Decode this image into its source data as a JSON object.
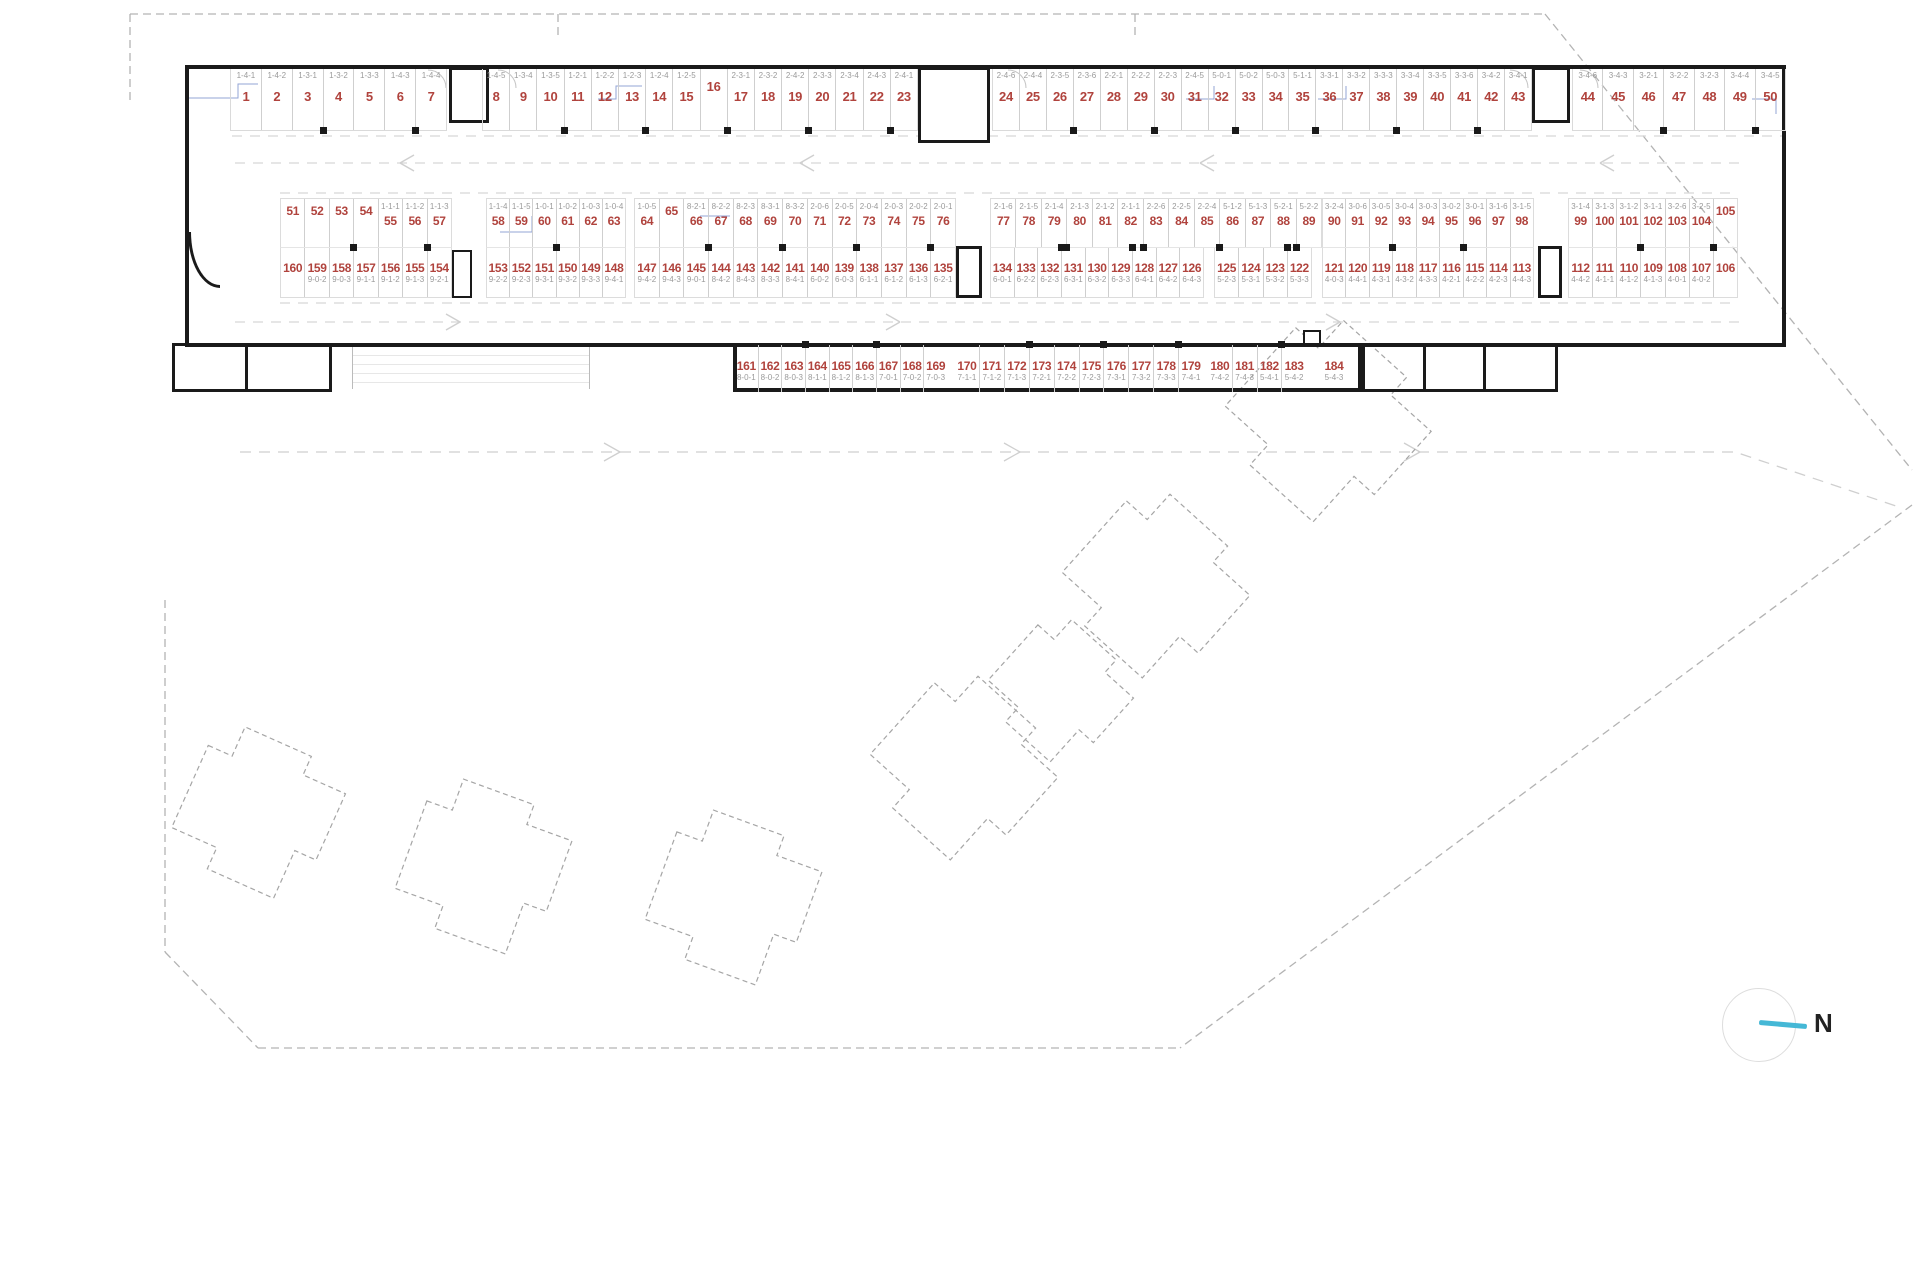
{
  "title": "underground parking level plan",
  "colors": {
    "space_number": "#b0433d",
    "space_code": "#9a9a9a",
    "wall": "#1a1a1a",
    "bay_line": "#cfcfcf",
    "site_dash": "#b3b3b3",
    "building_dash": "#a5a5a5",
    "blue_line": "#93a4d6",
    "north_needle": "#45b8d6"
  },
  "north": {
    "label": "N"
  },
  "parking": {
    "rows": [
      {
        "name": "top-row",
        "code_position": "above",
        "groups": [
          {
            "spaces": [
              {
                "n": "1",
                "c": "1-4-1"
              },
              {
                "n": "2",
                "c": "1-4-2"
              },
              {
                "n": "3",
                "c": "1-3-1"
              },
              {
                "n": "4",
                "c": "1-3-2"
              },
              {
                "n": "5",
                "c": "1-3-3"
              },
              {
                "n": "6",
                "c": "1-4-3"
              },
              {
                "n": "7",
                "c": "1-4-4"
              }
            ]
          },
          {
            "spaces": [
              {
                "n": "8",
                "c": "1-4-5"
              },
              {
                "n": "9",
                "c": "1-3-4"
              },
              {
                "n": "10",
                "c": "1-3-5"
              },
              {
                "n": "11",
                "c": "1-2-1"
              },
              {
                "n": "12",
                "c": "1-2-2"
              },
              {
                "n": "13",
                "c": "1-2-3"
              },
              {
                "n": "14",
                "c": "1-2-4"
              },
              {
                "n": "15",
                "c": "1-2-5"
              },
              {
                "n": "16",
                "c": ""
              },
              {
                "n": "17",
                "c": "2-3-1"
              },
              {
                "n": "18",
                "c": "2-3-2"
              },
              {
                "n": "19",
                "c": "2-4-2"
              },
              {
                "n": "20",
                "c": "2-3-3"
              },
              {
                "n": "21",
                "c": "2-3-4"
              },
              {
                "n": "22",
                "c": "2-4-3"
              },
              {
                "n": "23",
                "c": "2-4-1"
              }
            ]
          },
          {
            "spaces": [
              {
                "n": "24",
                "c": "2-4-6"
              },
              {
                "n": "25",
                "c": "2-4-4"
              },
              {
                "n": "26",
                "c": "2-3-5"
              },
              {
                "n": "27",
                "c": "2-3-6"
              },
              {
                "n": "28",
                "c": "2-2-1"
              },
              {
                "n": "29",
                "c": "2-2-2"
              },
              {
                "n": "30",
                "c": "2-2-3"
              },
              {
                "n": "31",
                "c": "2-4-5"
              },
              {
                "n": "32",
                "c": "5-0-1"
              },
              {
                "n": "33",
                "c": "5-0-2"
              },
              {
                "n": "34",
                "c": "5-0-3"
              },
              {
                "n": "35",
                "c": "5-1-1"
              },
              {
                "n": "36",
                "c": "3-3-1"
              },
              {
                "n": "37",
                "c": "3-3-2"
              },
              {
                "n": "38",
                "c": "3-3-3"
              },
              {
                "n": "39",
                "c": "3-3-4"
              },
              {
                "n": "40",
                "c": "3-3-5"
              },
              {
                "n": "41",
                "c": "3-3-6"
              },
              {
                "n": "42",
                "c": "3-4-2"
              },
              {
                "n": "43",
                "c": "3-4-1"
              }
            ]
          },
          {
            "spaces": [
              {
                "n": "44",
                "c": "3-4-6"
              },
              {
                "n": "45",
                "c": "3-4-3"
              },
              {
                "n": "46",
                "c": "3-2-1"
              },
              {
                "n": "47",
                "c": "3-2-2"
              },
              {
                "n": "48",
                "c": "3-2-3"
              },
              {
                "n": "49",
                "c": "3-4-4"
              },
              {
                "n": "50",
                "c": "3-4-5"
              }
            ]
          }
        ]
      },
      {
        "name": "middle-upper-row",
        "code_position": "above",
        "groups": [
          {
            "spaces": [
              {
                "n": "51",
                "c": ""
              },
              {
                "n": "52",
                "c": ""
              },
              {
                "n": "53",
                "c": ""
              },
              {
                "n": "54",
                "c": ""
              },
              {
                "n": "55",
                "c": "1-1-1"
              },
              {
                "n": "56",
                "c": "1-1-2"
              },
              {
                "n": "57",
                "c": "1-1-3"
              }
            ]
          },
          {
            "spaces": [
              {
                "n": "58",
                "c": "1-1-4"
              },
              {
                "n": "59",
                "c": "1-1-5"
              },
              {
                "n": "60",
                "c": "1-0-1"
              },
              {
                "n": "61",
                "c": "1-0-2"
              },
              {
                "n": "62",
                "c": "1-0-3"
              },
              {
                "n": "63",
                "c": "1-0-4"
              }
            ]
          },
          {
            "spaces": [
              {
                "n": "64",
                "c": "1-0-5"
              },
              {
                "n": "65",
                "c": ""
              },
              {
                "n": "66",
                "c": "8-2-1"
              },
              {
                "n": "67",
                "c": "8-2-2"
              },
              {
                "n": "68",
                "c": "8-2-3"
              },
              {
                "n": "69",
                "c": "8-3-1"
              },
              {
                "n": "70",
                "c": "8-3-2"
              },
              {
                "n": "71",
                "c": "2-0-6"
              },
              {
                "n": "72",
                "c": "2-0-5"
              },
              {
                "n": "73",
                "c": "2-0-4"
              },
              {
                "n": "74",
                "c": "2-0-3"
              },
              {
                "n": "75",
                "c": "2-0-2"
              },
              {
                "n": "76",
                "c": "2-0-1"
              }
            ]
          },
          {
            "spaces": [
              {
                "n": "77",
                "c": "2-1-6"
              },
              {
                "n": "78",
                "c": "2-1-5"
              },
              {
                "n": "79",
                "c": "2-1-4"
              },
              {
                "n": "80",
                "c": "2-1-3"
              },
              {
                "n": "81",
                "c": "2-1-2"
              },
              {
                "n": "82",
                "c": "2-1-1"
              },
              {
                "n": "83",
                "c": "2-2-6"
              },
              {
                "n": "84",
                "c": "2-2-5"
              },
              {
                "n": "85",
                "c": "2-2-4"
              },
              {
                "n": "86",
                "c": "5-1-2"
              },
              {
                "n": "87",
                "c": "5-1-3"
              },
              {
                "n": "88",
                "c": "5-2-1"
              },
              {
                "n": "89",
                "c": "5-2-2"
              }
            ]
          },
          {
            "spaces": [
              {
                "n": "90",
                "c": "3-2-4"
              },
              {
                "n": "91",
                "c": "3-0-6"
              },
              {
                "n": "92",
                "c": "3-0-5"
              },
              {
                "n": "93",
                "c": "3-0-4"
              },
              {
                "n": "94",
                "c": "3-0-3"
              },
              {
                "n": "95",
                "c": "3-0-2"
              },
              {
                "n": "96",
                "c": "3-0-1"
              },
              {
                "n": "97",
                "c": "3-1-6"
              },
              {
                "n": "98",
                "c": "3-1-5"
              }
            ]
          },
          {
            "spaces": [
              {
                "n": "99",
                "c": "3-1-4"
              },
              {
                "n": "100",
                "c": "3-1-3"
              },
              {
                "n": "101",
                "c": "3-1-2"
              },
              {
                "n": "102",
                "c": "3-1-1"
              },
              {
                "n": "103",
                "c": "3-2-6"
              },
              {
                "n": "104",
                "c": "3-2-5"
              },
              {
                "n": "105",
                "c": ""
              }
            ]
          }
        ]
      },
      {
        "name": "middle-lower-row",
        "code_position": "below",
        "groups": [
          {
            "spaces": [
              {
                "n": "160",
                "c": ""
              },
              {
                "n": "159",
                "c": "9-0-2"
              },
              {
                "n": "158",
                "c": "9-0-3"
              },
              {
                "n": "157",
                "c": "9-1-1"
              },
              {
                "n": "156",
                "c": "9-1-2"
              },
              {
                "n": "155",
                "c": "9-1-3"
              },
              {
                "n": "154",
                "c": "9-2-1"
              }
            ]
          },
          {
            "spaces": [
              {
                "n": "153",
                "c": "9-2-2"
              },
              {
                "n": "152",
                "c": "9-2-3"
              },
              {
                "n": "151",
                "c": "9-3-1"
              },
              {
                "n": "150",
                "c": "9-3-2"
              },
              {
                "n": "149",
                "c": "9-3-3"
              },
              {
                "n": "148",
                "c": "9-4-1"
              }
            ]
          },
          {
            "spaces": [
              {
                "n": "147",
                "c": "9-4-2"
              },
              {
                "n": "146",
                "c": "9-4-3"
              },
              {
                "n": "145",
                "c": "9-0-1"
              },
              {
                "n": "144",
                "c": "8-4-2"
              },
              {
                "n": "143",
                "c": "8-4-3"
              },
              {
                "n": "142",
                "c": "8-3-3"
              },
              {
                "n": "141",
                "c": "8-4-1"
              },
              {
                "n": "140",
                "c": "6-0-2"
              },
              {
                "n": "139",
                "c": "6-0-3"
              },
              {
                "n": "138",
                "c": "6-1-1"
              },
              {
                "n": "137",
                "c": "6-1-2"
              },
              {
                "n": "136",
                "c": "6-1-3"
              },
              {
                "n": "135",
                "c": "6-2-1"
              }
            ]
          },
          {
            "spaces": [
              {
                "n": "134",
                "c": "6-0-1"
              },
              {
                "n": "133",
                "c": "6-2-2"
              },
              {
                "n": "132",
                "c": "6-2-3"
              },
              {
                "n": "131",
                "c": "6-3-1"
              },
              {
                "n": "130",
                "c": "6-3-2"
              },
              {
                "n": "129",
                "c": "6-3-3"
              },
              {
                "n": "128",
                "c": "6-4-1"
              },
              {
                "n": "127",
                "c": "6-4-2"
              },
              {
                "n": "126",
                "c": "6-4-3"
              }
            ]
          },
          {
            "spaces": [
              {
                "n": "125",
                "c": "5-2-3"
              },
              {
                "n": "124",
                "c": "5-3-1"
              },
              {
                "n": "123",
                "c": "5-3-2"
              },
              {
                "n": "122",
                "c": "5-3-3"
              }
            ]
          },
          {
            "spaces": [
              {
                "n": "121",
                "c": "4-0-3"
              },
              {
                "n": "120",
                "c": "4-4-1"
              },
              {
                "n": "119",
                "c": "4-3-1"
              },
              {
                "n": "118",
                "c": "4-3-2"
              },
              {
                "n": "117",
                "c": "4-3-3"
              },
              {
                "n": "116",
                "c": "4-2-1"
              },
              {
                "n": "115",
                "c": "4-2-2"
              },
              {
                "n": "114",
                "c": "4-2-3"
              },
              {
                "n": "113",
                "c": "4-4-3"
              }
            ]
          },
          {
            "spaces": [
              {
                "n": "112",
                "c": "4-4-2"
              },
              {
                "n": "111",
                "c": "4-1-1"
              },
              {
                "n": "110",
                "c": "4-1-2"
              },
              {
                "n": "109",
                "c": "4-1-3"
              },
              {
                "n": "108",
                "c": "4-0-1"
              },
              {
                "n": "107",
                "c": "4-0-2"
              },
              {
                "n": "106",
                "c": ""
              }
            ]
          }
        ]
      },
      {
        "name": "bottom-row",
        "code_position": "below",
        "groups": [
          {
            "spaces": [
              {
                "n": "161",
                "c": "8-0-1"
              },
              {
                "n": "162",
                "c": "8-0-2"
              },
              {
                "n": "163",
                "c": "8-0-3"
              },
              {
                "n": "164",
                "c": "8-1-1"
              },
              {
                "n": "165",
                "c": "8-1-2"
              },
              {
                "n": "166",
                "c": "8-1-3"
              },
              {
                "n": "167",
                "c": "7-0-1"
              },
              {
                "n": "168",
                "c": "7-0-2"
              },
              {
                "n": "169",
                "c": "7-0-3"
              }
            ]
          },
          {
            "spaces": [
              {
                "n": "170",
                "c": "7-1-1"
              },
              {
                "n": "171",
                "c": "7-1-2"
              },
              {
                "n": "172",
                "c": "7-1-3"
              },
              {
                "n": "173",
                "c": "7-2-1"
              },
              {
                "n": "174",
                "c": "7-2-2"
              },
              {
                "n": "175",
                "c": "7-2-3"
              },
              {
                "n": "176",
                "c": "7-3-1"
              },
              {
                "n": "177",
                "c": "7-3-2"
              },
              {
                "n": "178",
                "c": "7-3-3"
              },
              {
                "n": "179",
                "c": "7-4-1"
              }
            ]
          },
          {
            "spaces": [
              {
                "n": "180",
                "c": "7-4-2"
              },
              {
                "n": "181",
                "c": "7-4-3"
              },
              {
                "n": "182",
                "c": "5-4-1"
              },
              {
                "n": "183",
                "c": "5-4-2"
              }
            ]
          },
          {
            "spaces": [
              {
                "n": "184",
                "c": "5-4-3"
              }
            ]
          }
        ]
      }
    ]
  }
}
